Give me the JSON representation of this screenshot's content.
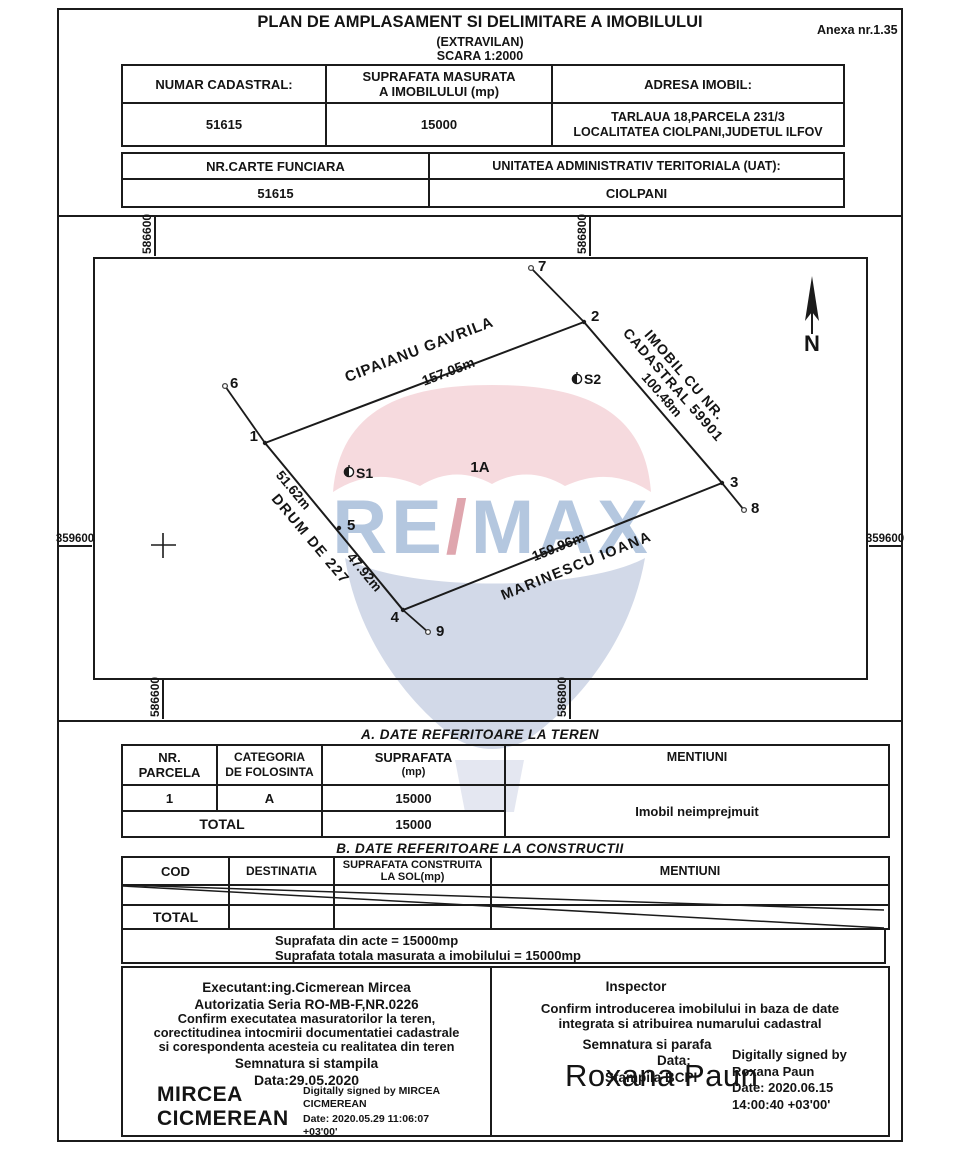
{
  "title": {
    "main": "PLAN DE AMPLASAMENT SI DELIMITARE A IMOBILULUI",
    "sub1": "(EXTRAVILAN)",
    "sub2": "SCARA 1:2000",
    "anexa": "Anexa nr.1.35"
  },
  "parcel_header": {
    "col1_label": "NUMAR CADASTRAL:",
    "col2_label_1": "SUPRAFATA MASURATA",
    "col2_label_2": "A IMOBILULUI (mp)",
    "col3_label": "ADRESA IMOBIL:",
    "col1_value": "51615",
    "col2_value": "15000",
    "col3_value_1": "TARLAUA 18,PARCELA 231/3",
    "col3_value_2": "LOCALITATEA CIOLPANI,JUDETUL ILFOV"
  },
  "land_book": {
    "col1_label": "NR.CARTE FUNCIARA",
    "col2_label": "UNITATEA ADMINISTRATIV TERITORIALA (UAT):",
    "col1_value": "51615",
    "col2_value": "CIOLPANI"
  },
  "map": {
    "grid": {
      "easting_1": "586600",
      "easting_2": "586800",
      "northing": "359600"
    },
    "north_label": "N",
    "parcel_label": "1A",
    "station_1": "S1",
    "station_2": "S2",
    "points": [
      "1",
      "2",
      "3",
      "4",
      "5",
      "6",
      "7",
      "8",
      "9"
    ],
    "neighbors": {
      "north_name": "CIPAIANU GAVRILA",
      "north_len": "157.05m",
      "east_name_1": "IMOBIL CU NR.",
      "east_name_2": "CADASTRAL 59901",
      "east_len": "100.48m",
      "south_len": "159.96m",
      "south_name": "MARINESCU IOANA",
      "west_len_1": "51.62m",
      "west_name": "DRUM DE 227",
      "west_len_2": "47.92m"
    }
  },
  "watermark": {
    "re": "RE",
    "slash": "/",
    "max": "MAX"
  },
  "table_a": {
    "title": "A. DATE REFERITOARE LA TEREN",
    "h_nr_1": "NR.",
    "h_nr_2": "PARCELA",
    "h_cat_1": "CATEGORIA",
    "h_cat_2": "DE FOLOSINTA",
    "h_sup_1": "SUPRAFATA",
    "h_sup_2": "(mp)",
    "h_men": "MENTIUNI",
    "row_nr": "1",
    "row_cat": "A",
    "row_sup": "15000",
    "row_men": "Imobil neimprejmuit",
    "total_label": "TOTAL",
    "total_sup": "15000"
  },
  "table_b": {
    "title": "B. DATE REFERITOARE LA CONSTRUCTII",
    "h_cod": "COD",
    "h_dest": "DESTINATIA",
    "h_sup_1": "SUPRAFATA CONSTRUITA",
    "h_sup_2": "LA SOL(mp)",
    "h_men": "MENTIUNI",
    "total_label": "TOTAL"
  },
  "totals": {
    "line1": "Suprafata din acte = 15000mp",
    "line2": "Suprafata totala masurata a imobilului = 15000mp"
  },
  "executant": {
    "line1": "Executant:ing.Cicmerean Mircea",
    "line2": "Autorizatia Seria RO-MB-F,NR.0226",
    "line3": "Confirm executatea masuratorilor la teren,",
    "line4": "corectitudinea intocmirii documentatiei cadastrale",
    "line5": "si corespondenta acesteia cu realitatea din teren",
    "line6": "Semnatura si stampila",
    "line7": "Data:29.05.2020",
    "sig_name_1": "MIRCEA",
    "sig_name_2": "CICMEREAN",
    "sig_note_1": "Digitally signed by MIRCEA",
    "sig_note_2": "CICMEREAN",
    "sig_note_3": "Date: 2020.05.29 11:06:07",
    "sig_note_4": "+03'00'"
  },
  "inspector": {
    "line1": "Inspector",
    "line2": "Confirm introducerea imobilului in baza de date",
    "line3": "integrata si atribuirea numarului cadastral",
    "line4": "Semnatura si parafa",
    "line5": "Data:",
    "line6": "Stampila BCPI",
    "sig_name": "Roxana Paun",
    "sig_note_1": "Digitally signed by",
    "sig_note_2": "Roxana Paun",
    "sig_note_3": "Date: 2020.06.15",
    "sig_note_4": "14:00:40 +03'00'"
  }
}
